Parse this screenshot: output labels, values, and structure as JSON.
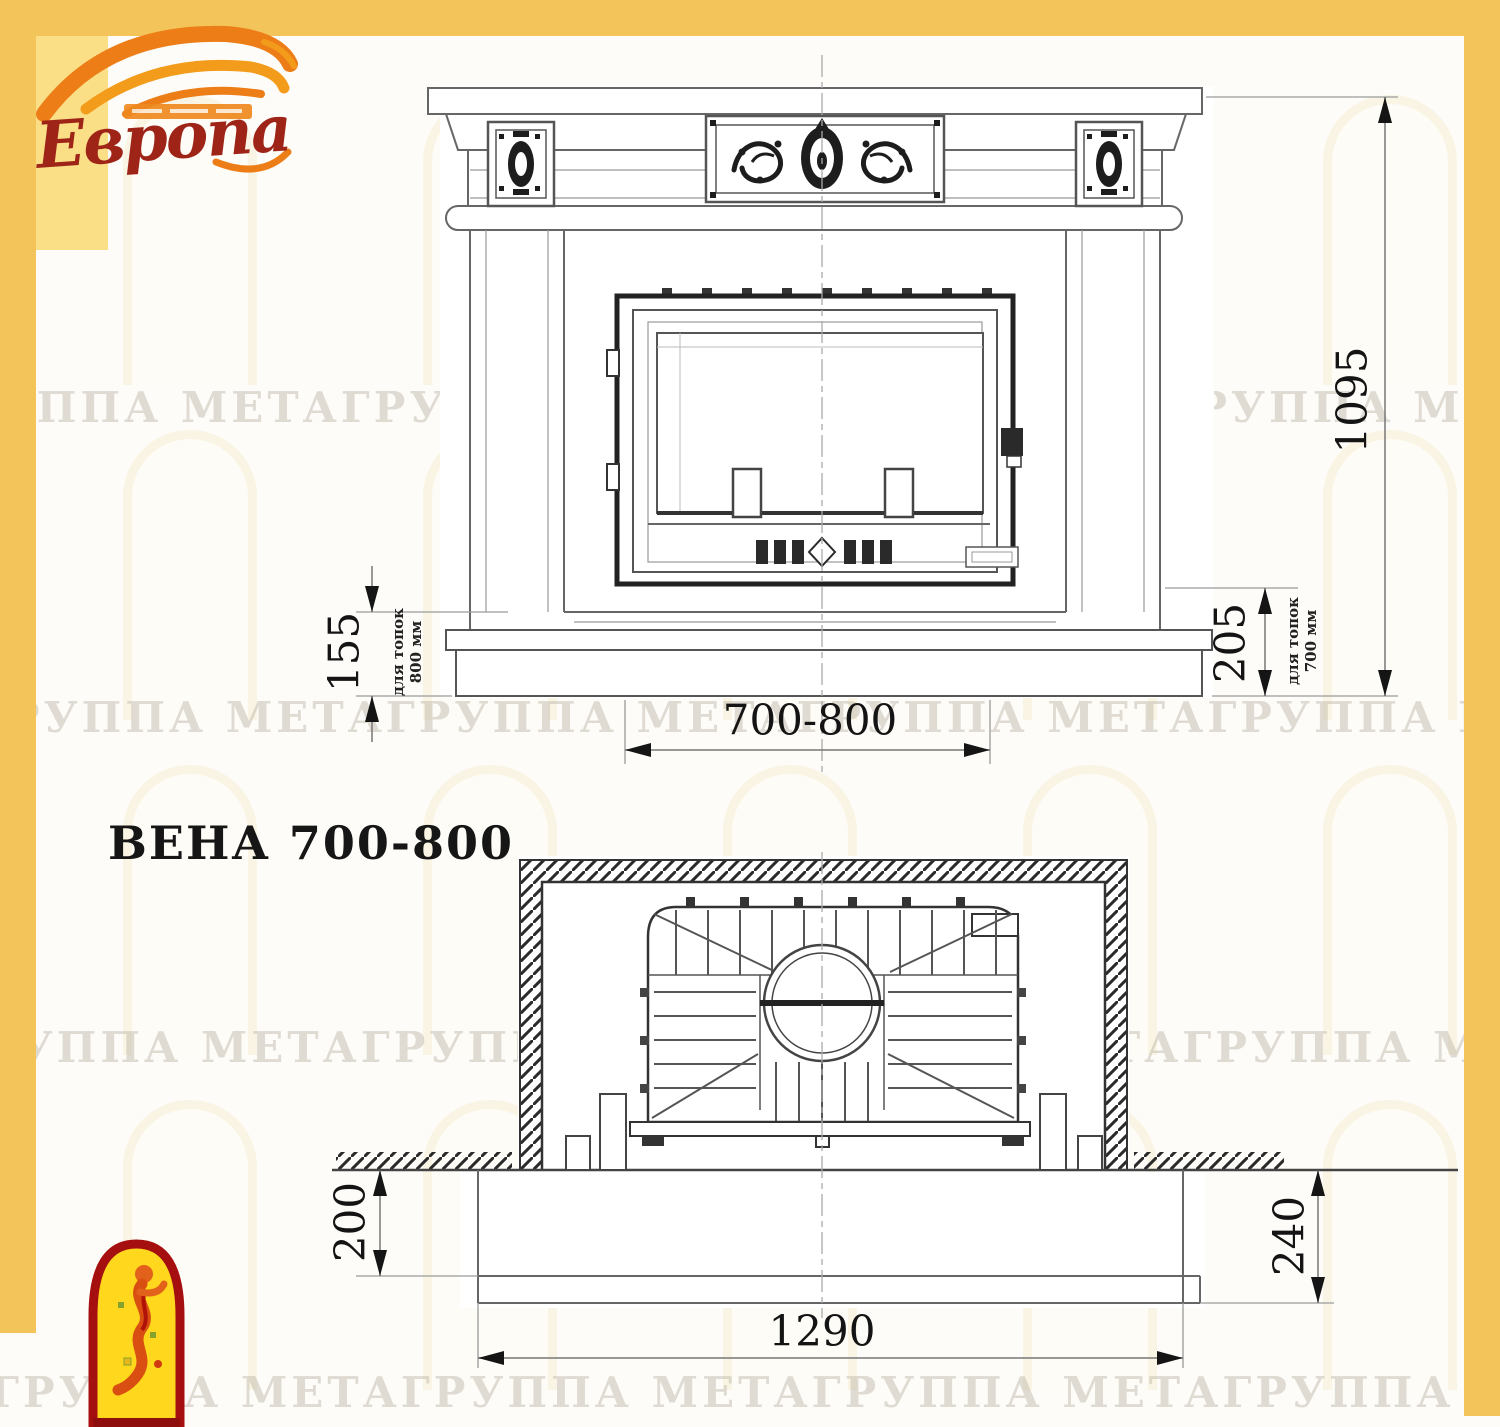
{
  "logo": {
    "brand": "Европа"
  },
  "title": "ВЕНА 700-800",
  "watermark": {
    "text": "ГРУППА МЕТАГРУППА МЕТАГРУППА МЕТАГРУППА МЕТА"
  },
  "front_view": {
    "dim_height": "1095",
    "dim_pedestal_left": "155",
    "note_left_line1": "для топок",
    "note_left_line2": "800 мм",
    "dim_pedestal_right": "205",
    "note_right_line1": "для топок",
    "note_right_line2": "700 мм",
    "dim_opening_width": "700-800"
  },
  "plan_view": {
    "dim_depth_left": "200",
    "dim_depth_right": "240",
    "dim_width": "1290"
  }
}
